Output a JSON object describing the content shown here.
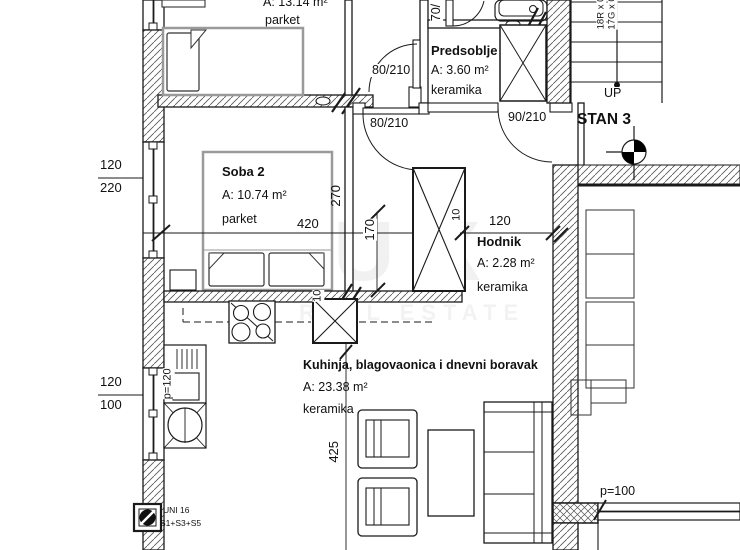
{
  "unit_label": "STAN 3",
  "rooms": {
    "soba1": {
      "area": "A: 13.14 m²",
      "floor": "parket"
    },
    "soba2": {
      "name": "Soba 2",
      "area": "A: 10.74 m²",
      "floor": "parket"
    },
    "predsoblje": {
      "name": "Predsoblje",
      "area": "A: 3.60 m²",
      "floor": "keramika"
    },
    "hodnik": {
      "name": "Hodnik",
      "area": "A: 2.28 m²",
      "floor": "keramika"
    },
    "kuhinja": {
      "name": "Kuhinja, blagovaonica i dnevni boravak",
      "area": "A: 23.38 m²",
      "floor": "keramika"
    }
  },
  "doors": {
    "top": "80/210",
    "vestibule": "80/210",
    "predsoblje": "90/210",
    "bath": "70/"
  },
  "windows": {
    "win1_width": "120",
    "win1_height": "220",
    "win2_width": "120",
    "win2_height": "100",
    "parapet_kitchen": "p=120",
    "parapet_living": "p=100"
  },
  "dimensions": {
    "soba2_width": "420",
    "soba2_depth": "270",
    "strip": "170",
    "hodnik_width": "120",
    "living_depth": "425",
    "wall_a": "10",
    "wall_b": "10"
  },
  "stairs": {
    "up": "UP",
    "risers": "18R x 0",
    "goings": "17G x 0"
  },
  "annotations": {
    "uni_line1": "UNI 16",
    "uni_line2": "S1+S3+S5"
  },
  "watermark": {
    "line1": "DUX",
    "line2": "REAL ESTATE"
  },
  "colors": {
    "line": "#1a1a1a",
    "furniture_gray": "#9a9a9a"
  }
}
